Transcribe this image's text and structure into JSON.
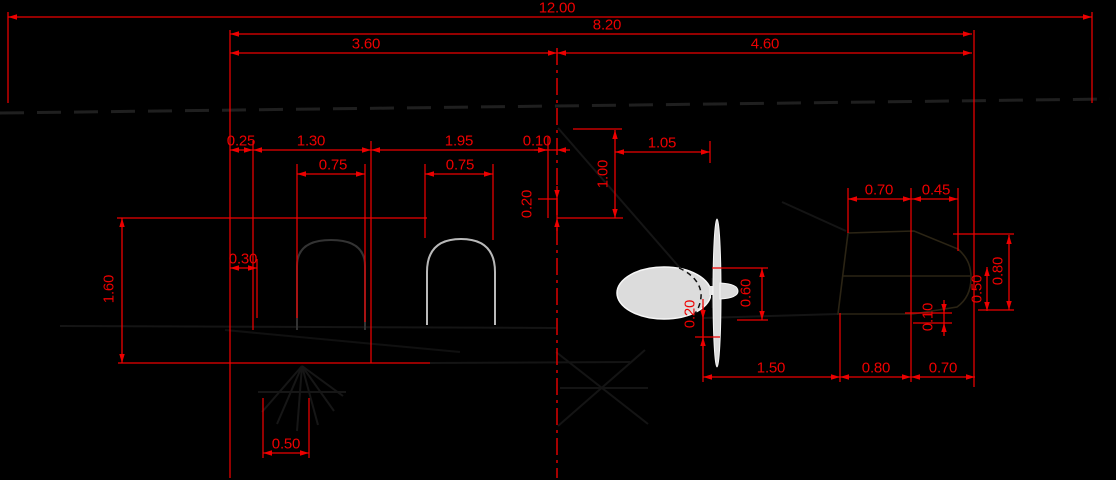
{
  "drawing": {
    "type": "CAD stern arrangement drawing, side profile with propeller pod, thruster tunnel and rudder",
    "units_shown": "meters",
    "colors": {
      "background": "#000000",
      "dimension": "#ed0000",
      "centerline": "#ed0000",
      "waterline": "#1f1f1f",
      "hull": "#161616",
      "hull_faint": "#101010",
      "tunnel_gray": "#3c3c3c",
      "arch": "#b9b9b9",
      "pod_fill": "#dcdcdc",
      "pod_stroke": "#f7f7f7",
      "rudder": "#2b2414"
    }
  },
  "centerline": {
    "x": 557,
    "y1": 48,
    "y2": 478
  },
  "dimensions": [
    {
      "name": "overall-length",
      "label": "12.00",
      "orient": "h",
      "pos": 17,
      "from": 8,
      "to": 1092,
      "tx": 557,
      "ty": 8,
      "arrows": "in"
    },
    {
      "name": "aft-length",
      "label": "8.20",
      "orient": "h",
      "pos": 34,
      "from": 230,
      "to": 972,
      "tx": 607,
      "ty": 25,
      "arrows": "in"
    },
    {
      "name": "mid-to-cl",
      "label": "3.60",
      "orient": "h",
      "pos": 53,
      "from": 230,
      "to": 557,
      "tx": 366,
      "ty": 44,
      "arrows": "in"
    },
    {
      "name": "cl-to-ap",
      "label": "4.60",
      "orient": "h",
      "pos": 53,
      "from": 557,
      "to": 972,
      "tx": 765,
      "ty": 44,
      "arrows": "in"
    },
    {
      "name": "offset-025",
      "label": "0.25",
      "orient": "h",
      "pos": 150,
      "from": 230,
      "to": 253,
      "tx": 241,
      "ty": 141,
      "arrows": "in"
    },
    {
      "name": "bay-130",
      "label": "1.30",
      "orient": "h",
      "pos": 150,
      "from": 253,
      "to": 371,
      "tx": 311,
      "ty": 141,
      "arrows": "in"
    },
    {
      "name": "bay-195",
      "label": "1.95",
      "orient": "h",
      "pos": 150,
      "from": 371,
      "to": 547,
      "tx": 459,
      "ty": 141,
      "arrows": "in"
    },
    {
      "name": "gap-010",
      "label": "0.10",
      "orient": "h",
      "pos": 150,
      "from": 547,
      "to": 557,
      "tx": 537,
      "ty": 141,
      "arrows": "out"
    },
    {
      "name": "tunnel1-width",
      "label": "0.75",
      "orient": "h",
      "pos": 174,
      "from": 297,
      "to": 365,
      "tx": 333,
      "ty": 165,
      "arrows": "in"
    },
    {
      "name": "tunnel2-width",
      "label": "0.75",
      "orient": "h",
      "pos": 174,
      "from": 425,
      "to": 493,
      "tx": 460,
      "ty": 165,
      "arrows": "in"
    },
    {
      "name": "cl-to-prop",
      "label": "1.05",
      "orient": "h",
      "pos": 152,
      "from": 615,
      "to": 710,
      "tx": 662,
      "ty": 143,
      "arrows": "in"
    },
    {
      "name": "rudder-top-070",
      "label": "0.70",
      "orient": "h",
      "pos": 199,
      "from": 848,
      "to": 912,
      "tx": 879,
      "ty": 190,
      "arrows": "in"
    },
    {
      "name": "rudder-top-045",
      "label": "0.45",
      "orient": "h",
      "pos": 199,
      "from": 912,
      "to": 958,
      "tx": 936,
      "ty": 190,
      "arrows": "in"
    },
    {
      "name": "offset-030",
      "label": "0.30",
      "orient": "h",
      "pos": 268,
      "from": 230,
      "to": 257,
      "tx": 243,
      "ty": 259,
      "arrows": "in"
    },
    {
      "name": "bottom-050",
      "label": "0.50",
      "orient": "h",
      "pos": 453,
      "from": 263,
      "to": 309,
      "tx": 286,
      "ty": 444,
      "arrows": "in"
    },
    {
      "name": "prop-to-rudder",
      "label": "1.50",
      "orient": "h",
      "pos": 377,
      "from": 703,
      "to": 840,
      "tx": 771,
      "ty": 368,
      "arrows": "in"
    },
    {
      "name": "rudder-bot-080",
      "label": "0.80",
      "orient": "h",
      "pos": 377,
      "from": 840,
      "to": 911,
      "tx": 876,
      "ty": 368,
      "arrows": "in"
    },
    {
      "name": "rudder-bot-070",
      "label": "0.70",
      "orient": "h",
      "pos": 377,
      "from": 911,
      "to": 975,
      "tx": 943,
      "ty": 368,
      "arrows": "in"
    },
    {
      "name": "depth-160",
      "label": "1.60",
      "orient": "v",
      "pos": 122,
      "from": 218,
      "to": 363,
      "tx": 109,
      "ty": 289,
      "arrows": "in"
    },
    {
      "name": "height-100",
      "label": "1.00",
      "orient": "v",
      "pos": 615,
      "from": 130,
      "to": 218,
      "tx": 603,
      "ty": 174,
      "arrows": "in"
    },
    {
      "name": "cl-020",
      "label": "0.20",
      "orient": "v",
      "pos": 557,
      "from": 199,
      "to": 218,
      "tx": 527,
      "ty": 204,
      "arrows": "out"
    },
    {
      "name": "pod-height-060",
      "label": "0.60",
      "orient": "v",
      "pos": 762,
      "from": 268,
      "to": 320,
      "tx": 746,
      "ty": 293,
      "arrows": "in"
    },
    {
      "name": "pod-clearance-020",
      "label": "0.20",
      "orient": "v",
      "pos": 703,
      "from": 319,
      "to": 337,
      "tx": 690,
      "ty": 314,
      "arrows": "out"
    },
    {
      "name": "rudder-050",
      "label": "0.50",
      "orient": "v",
      "pos": 987,
      "from": 267,
      "to": 311,
      "tx": 977,
      "ty": 289,
      "arrows": "in"
    },
    {
      "name": "rudder-height-080",
      "label": "0.80",
      "orient": "v",
      "pos": 1009,
      "from": 235,
      "to": 310,
      "tx": 998,
      "ty": 271,
      "arrows": "in"
    },
    {
      "name": "rudder-rake-010",
      "label": "0.10",
      "orient": "v",
      "pos": 944,
      "from": 313,
      "to": 323,
      "tx": 928,
      "ty": 317,
      "arrows": "out"
    }
  ],
  "extension_lines": [
    [
      8,
      12,
      8,
      103
    ],
    [
      1092,
      12,
      1092,
      103
    ],
    [
      230,
      30,
      230,
      478
    ],
    [
      974,
      30,
      974,
      387
    ],
    [
      253,
      141,
      253,
      330
    ],
    [
      371,
      141,
      371,
      363
    ],
    [
      548,
      137,
      548,
      218
    ],
    [
      297,
      164,
      297,
      318
    ],
    [
      365,
      164,
      365,
      322
    ],
    [
      425,
      164,
      425,
      238
    ],
    [
      493,
      164,
      493,
      240
    ],
    [
      257,
      259,
      257,
      318
    ],
    [
      117,
      218,
      427,
      218
    ],
    [
      118,
      363,
      430,
      363
    ],
    [
      573,
      129,
      622,
      129
    ],
    [
      557,
      218,
      623,
      218
    ],
    [
      538,
      199,
      557,
      199
    ],
    [
      710,
      141,
      710,
      163
    ],
    [
      712,
      268,
      768,
      268
    ],
    [
      737,
      320,
      768,
      320
    ],
    [
      703,
      299,
      703,
      382
    ],
    [
      695,
      337,
      720,
      337
    ],
    [
      840,
      313,
      840,
      382
    ],
    [
      911,
      188,
      911,
      382
    ],
    [
      848,
      188,
      848,
      233
    ],
    [
      958,
      188,
      958,
      251
    ],
    [
      953,
      234,
      1014,
      234
    ],
    [
      978,
      310,
      1014,
      310
    ],
    [
      905,
      313,
      952,
      313
    ],
    [
      913,
      323,
      952,
      323
    ],
    [
      263,
      398,
      263,
      458
    ],
    [
      309,
      398,
      309,
      458
    ]
  ]
}
